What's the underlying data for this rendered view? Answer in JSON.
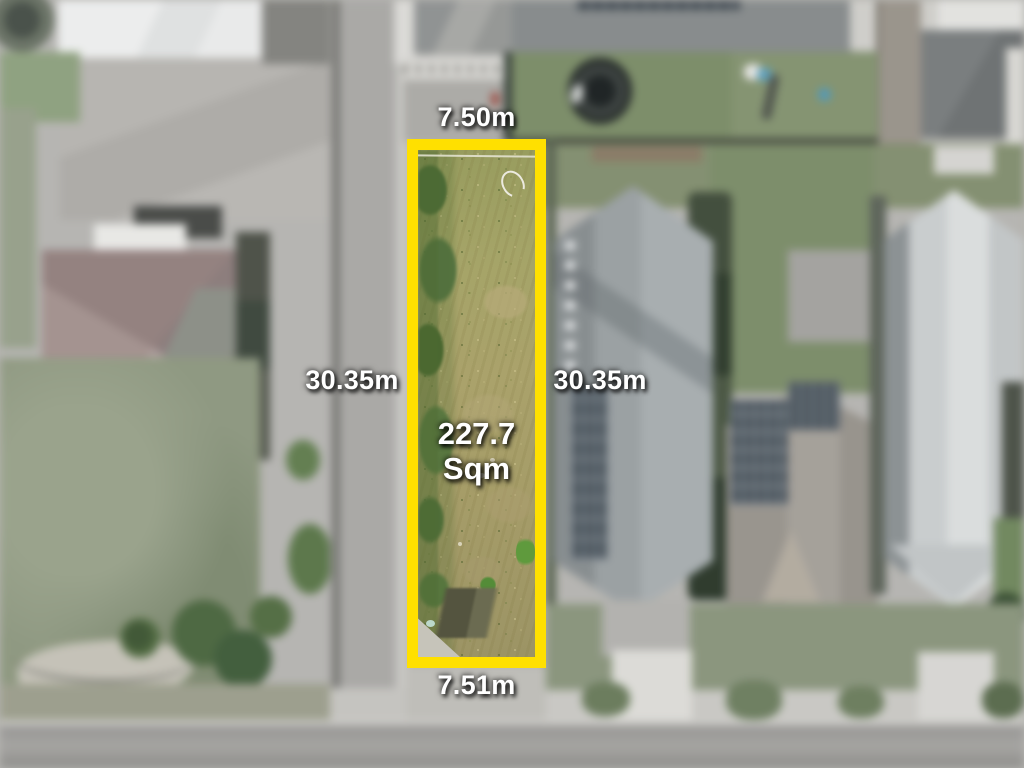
{
  "lot": {
    "area": {
      "value": "227.7",
      "unit": "Sqm"
    },
    "dimensions": {
      "top": "7.50m",
      "bottom": "7.51m",
      "left": "30.35m",
      "right": "30.35m"
    },
    "border_color": "#FFE000",
    "label_text_color": "#FFFFFF"
  }
}
